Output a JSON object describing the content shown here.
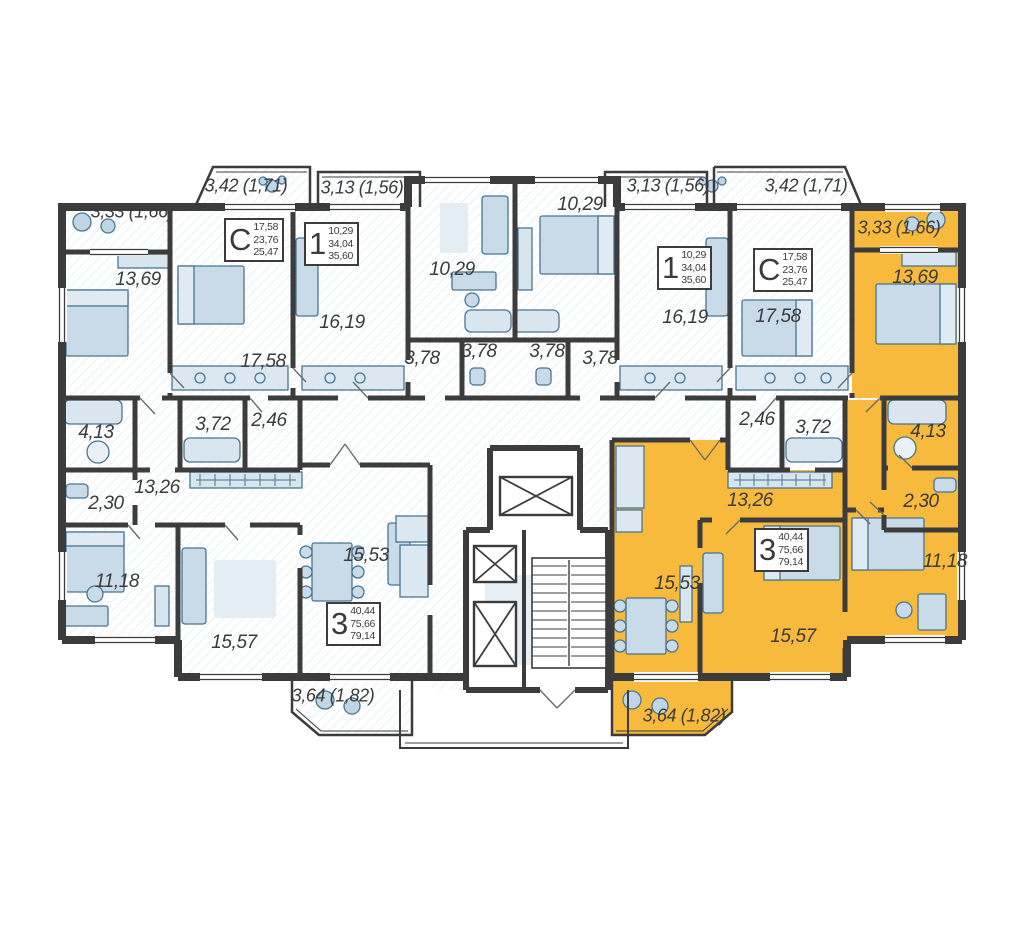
{
  "plan": {
    "type": "residential-floor-plan",
    "highlight_color": "#F7BA3C",
    "wall_color": "#3C3C3C",
    "furniture_color": "#C9DBE8",
    "balconies": [
      "3,33 (1,66)",
      "3,42 (1,71)",
      "3,13 (1,56)",
      "3,13 (1,56)",
      "3,42 (1,71)",
      "3,33 (1,66)",
      "3,64 (1,82)",
      "3,64 (1,82)"
    ],
    "rooms": [
      "13,69",
      "17,58",
      "16,19",
      "10,29",
      "3,78",
      "3,78",
      "3,78",
      "3,78",
      "10,29",
      "16,19",
      "17,58",
      "13,69",
      "4,13",
      "3,72",
      "2,46",
      "13,26",
      "2,30",
      "11,18",
      "15,53",
      "15,57",
      "2,46",
      "3,72",
      "4,13",
      "13,26",
      "2,30",
      "15,53",
      "15,57",
      "11,18"
    ],
    "stamps": [
      {
        "letter": "С",
        "values": [
          "17,58",
          "23,76",
          "25,47"
        ]
      },
      {
        "letter": "1",
        "values": [
          "10,29",
          "34,04",
          "35,60"
        ]
      },
      {
        "letter": "1",
        "values": [
          "10,29",
          "34,04",
          "35,60"
        ]
      },
      {
        "letter": "С",
        "values": [
          "17,58",
          "23,76",
          "25,47"
        ]
      },
      {
        "letter": "3",
        "values": [
          "40,44",
          "75,66",
          "79,14"
        ]
      },
      {
        "letter": "3",
        "values": [
          "40,44",
          "75,66",
          "79,14"
        ]
      }
    ]
  }
}
